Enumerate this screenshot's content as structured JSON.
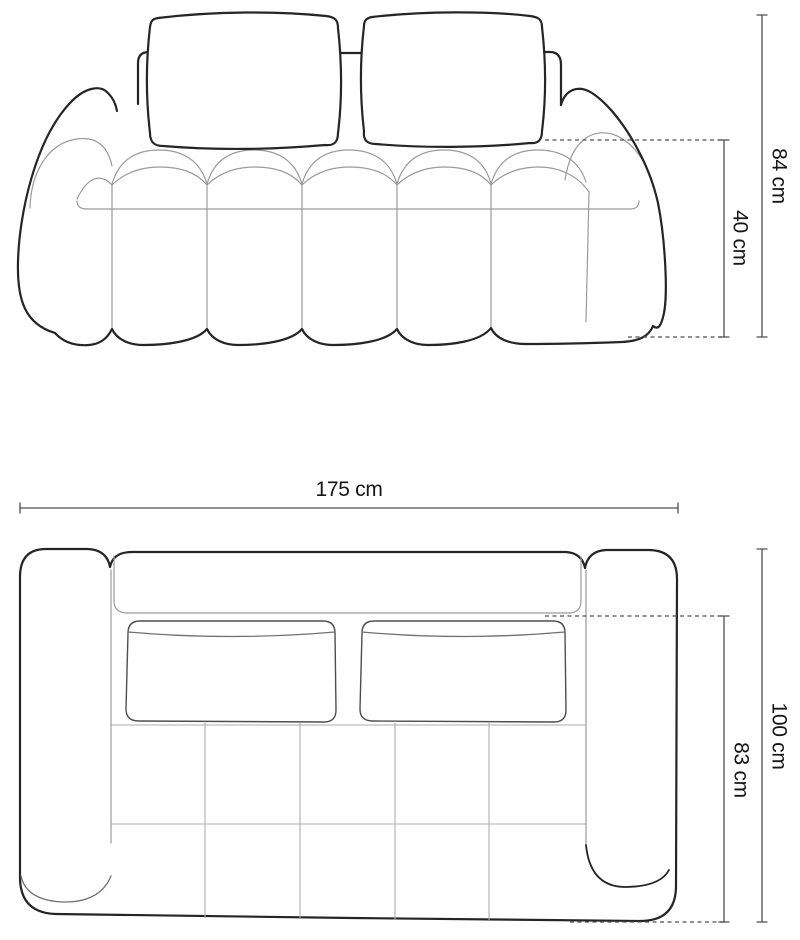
{
  "diagram": {
    "dimensions": {
      "front_total_height": "84 cm",
      "front_seat_height": "40 cm",
      "top_total_width": "175 cm",
      "top_total_depth": "100 cm",
      "top_seat_depth": "83 cm"
    },
    "colors": {
      "outline": "#252525",
      "seam": "#9b9b9b",
      "grid": "#aeaeae",
      "dimension_line": "#4f4f4f",
      "label_text": "#161616",
      "background": "#ffffff"
    }
  }
}
